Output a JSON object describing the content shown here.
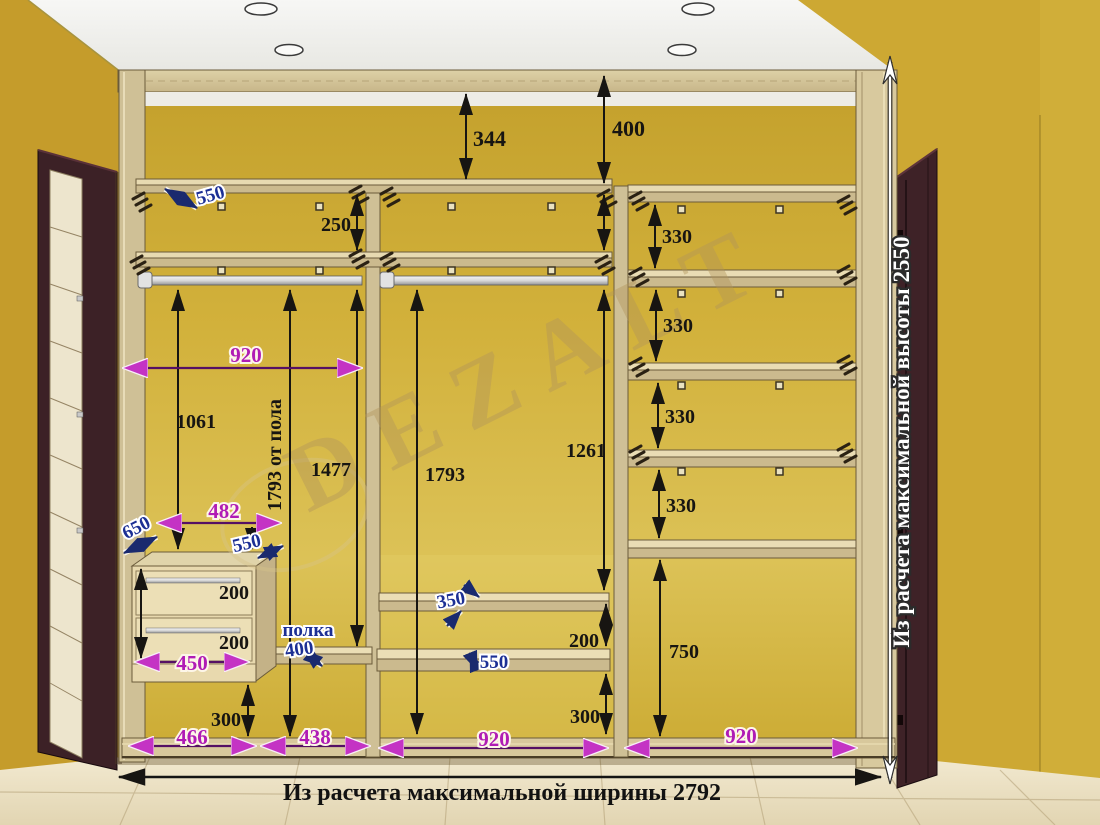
{
  "watermark": "DEZALT",
  "notes": {
    "bottom_width": "Из расчета максимальной ширины 2792",
    "right_height": "Из расчета максимальной высоты 2550"
  },
  "dims": {
    "top_gap_left": "344",
    "top_gap_right": "400",
    "top_shelf_depth": "550",
    "upper_shelf_gap": "250",
    "right_gap_1": "330",
    "right_gap_2": "330",
    "right_gap_3": "330",
    "right_gap_4": "330",
    "right_bottom_gap": "750",
    "s1_width": "920",
    "rod_to_drawer": "1061",
    "rod_from_floor": "1793 от пола",
    "rod_to_polka": "1477",
    "s2_rod_to_floor": "1793",
    "s2_rod_to_shelf": "1261",
    "drawer_top_width": "482",
    "drawer_side_depth": "650",
    "drawer_top_depth": "550",
    "drawer_h_1": "200",
    "drawer_h_2": "200",
    "drawer_width": "450",
    "drawer_floor_gap": "300",
    "s1_base_width": "466",
    "polka_word": "полка",
    "polka_dim": "400",
    "s1b_base_width": "438",
    "shelf_depth_350": "350",
    "shelf_depth_550": "550",
    "s2_shelf_gap": "200",
    "s2_floor_gap": "300",
    "s2_base_width": "920",
    "s3_base_width": "920"
  }
}
